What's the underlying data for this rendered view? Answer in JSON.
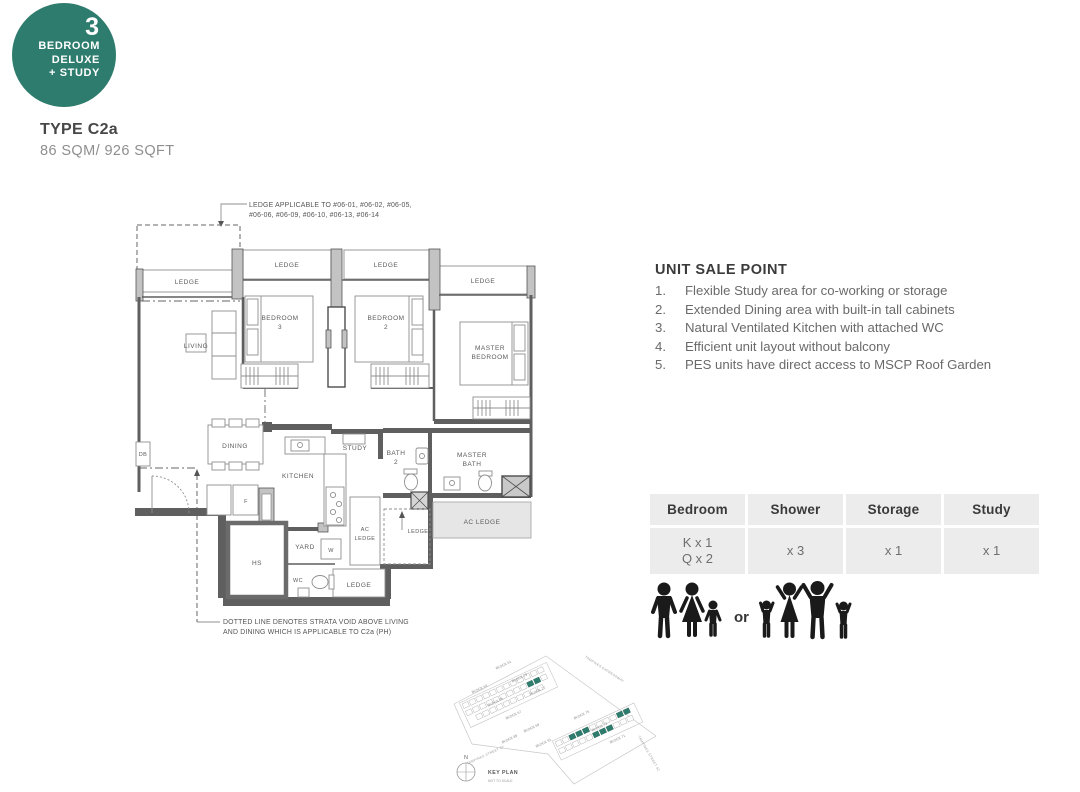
{
  "badge": {
    "number": "3",
    "lines": [
      "BEDROOM",
      "DELUXE",
      "+ STUDY"
    ],
    "color": "#2e7c6d"
  },
  "unit": {
    "type_label": "TYPE C2a",
    "area_label": "86 SQM/ 926 SQFT"
  },
  "sale_points": {
    "title": "UNIT SALE POINT",
    "numbers": [
      "1.",
      "2.",
      "3.",
      "4.",
      "5."
    ],
    "items": [
      "Flexible Study area for co-working or storage",
      "Extended Dining area with built-in tall cabinets",
      "Natural Ventilated Kitchen with attached WC",
      "Efficient unit layout without balcony",
      "PES units have direct access to MSCP Roof Garden"
    ]
  },
  "spec_table": {
    "columns": [
      "Bedroom",
      "Shower",
      "Storage",
      "Study"
    ],
    "bedroom_line1": "K x 1",
    "bedroom_line2": "Q x 2",
    "shower": "x 3",
    "storage": "x 1",
    "study": "x 1"
  },
  "occupancy": {
    "separator": "or"
  },
  "plan": {
    "labels": {
      "ledge": "LEDGE",
      "living": "LIVING",
      "bedroom": "BEDROOM",
      "bed3_num": "3",
      "bed2_num": "2",
      "master": "MASTER",
      "bath": "BATH",
      "bath2_num": "2",
      "dining": "DINING",
      "kitchen": "KITCHEN",
      "study": "STUDY",
      "ac": "AC",
      "ac_ledge": "AC LEDGE",
      "db": "DB",
      "fridge": "F",
      "hs": "HS",
      "yard": "YARD",
      "washer": "W",
      "wc": "WC"
    },
    "notes": {
      "ledge_note_line1": "LEDGE APPLICABLE TO #06-01, #06-02, #06-05,",
      "ledge_note_line2": "#06-06, #06-09, #06-10, #06-13, #06-14",
      "strata_note_line1": "DOTTED LINE DENOTES STRATA VOID ABOVE LIVING",
      "strata_note_line2": "AND DINING WHICH IS APPLICABLE TO C2a (PH)"
    }
  },
  "key_plan": {
    "title": "KEY PLAN",
    "subtitle": "NOT TO SCALE",
    "north_label": "N",
    "highlight_color": "#2e7c6d",
    "roads": [
      "TAMPINES EXPRESSWAY",
      "TAMPINES STREET 62",
      "TAMPINES STREET 62"
    ],
    "blocks": [
      "BLOCK 61",
      "BLOCK 79",
      "BLOCK 77",
      "BLOCK 63",
      "BLOCK 65",
      "BLOCK 67",
      "BLOCK 69",
      "BLOCK 89",
      "BLOCK 91",
      "BLOCK 75",
      "BLOCK 73",
      "BLOCK 71"
    ]
  }
}
